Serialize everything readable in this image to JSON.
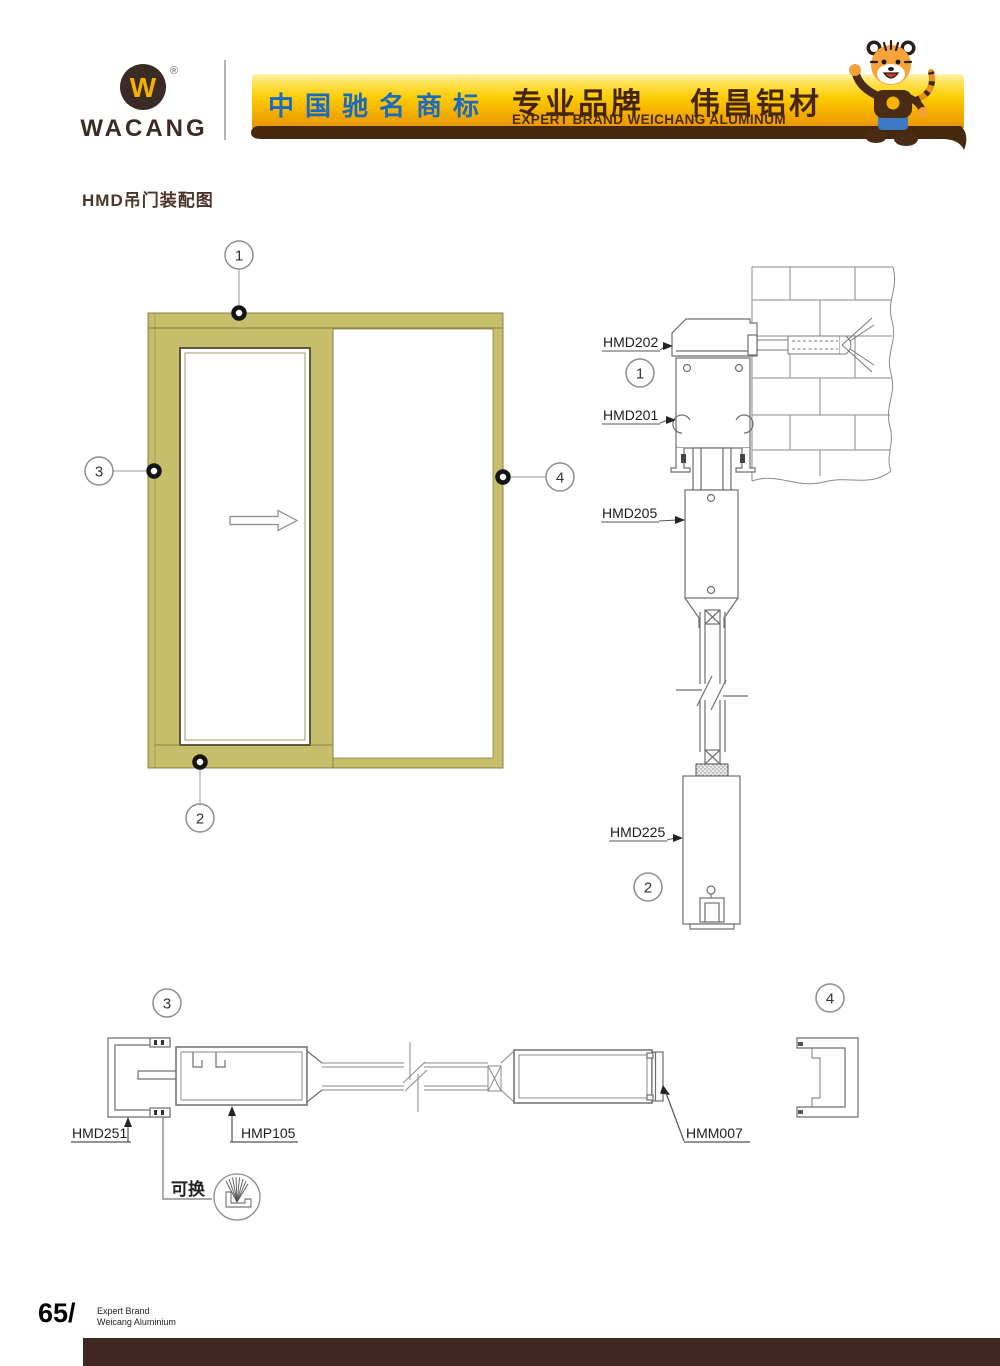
{
  "header": {
    "brand": "WACANG",
    "registered_mark": "®",
    "monogram": "W",
    "banner": {
      "cn_trademark": "中国驰名商标",
      "cn_brand": "专业品牌",
      "cn_company": "伟昌铝材",
      "en_caption": "EXPERT BRAND WEICHANG ALUMINUM"
    }
  },
  "title": "HMD吊门装配图",
  "elevation": {
    "callouts": {
      "c1": "1",
      "c2": "2",
      "c3": "3",
      "c4": "4"
    }
  },
  "vertical_section": {
    "label_top_frame": "HMD202",
    "label_track": "HMD201",
    "label_door_top": "HMD205",
    "label_door_bottom": "HMD225",
    "callout_top": "1",
    "callout_bottom": "2"
  },
  "horizontal_section": {
    "label_jamb": "HMD251",
    "label_stile": "HMP105",
    "label_meeting": "HMM007",
    "callout_left": "3",
    "callout_right": "4",
    "replaceable_note": "可换"
  },
  "footer": {
    "page_number": "65/",
    "brand_line1": "Expert Brand",
    "brand_line2": "Weicang Aluminium"
  },
  "colors": {
    "frame_olive": "#c6be6a",
    "frame_olive_outline": "#8a8245",
    "drawing_line": "#6e6e6e",
    "banner_gold_top": "#fff3b0",
    "banner_gold_bottom": "#ea9500",
    "ribbon_brown": "#46280f",
    "trademark_blue": "#1a6ac0",
    "brand_brown": "#3b2b25",
    "footer_bar_brown": "#3f2620"
  }
}
